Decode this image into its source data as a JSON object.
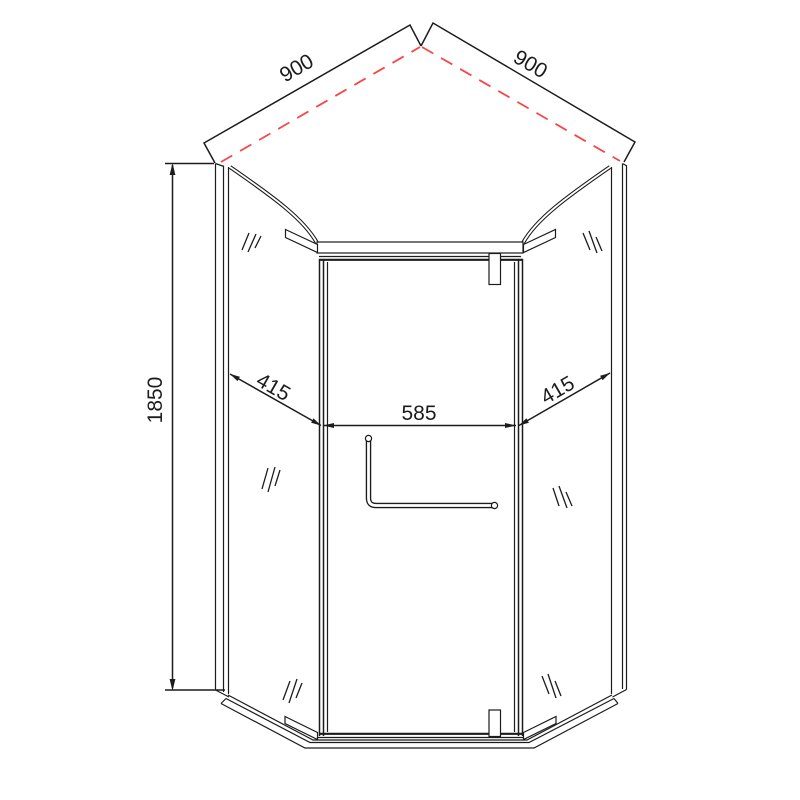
{
  "drawing": {
    "title": "Neo-angle corner shower enclosure technical drawing",
    "dimensions": {
      "top_left_edge": "900",
      "top_right_edge": "900",
      "height": "1850",
      "left_panel": "415",
      "door_width": "585",
      "right_panel": "415"
    },
    "colors": {
      "line": "#1c1c1c",
      "dimension_red": "#f44848",
      "background": "#ffffff"
    }
  }
}
